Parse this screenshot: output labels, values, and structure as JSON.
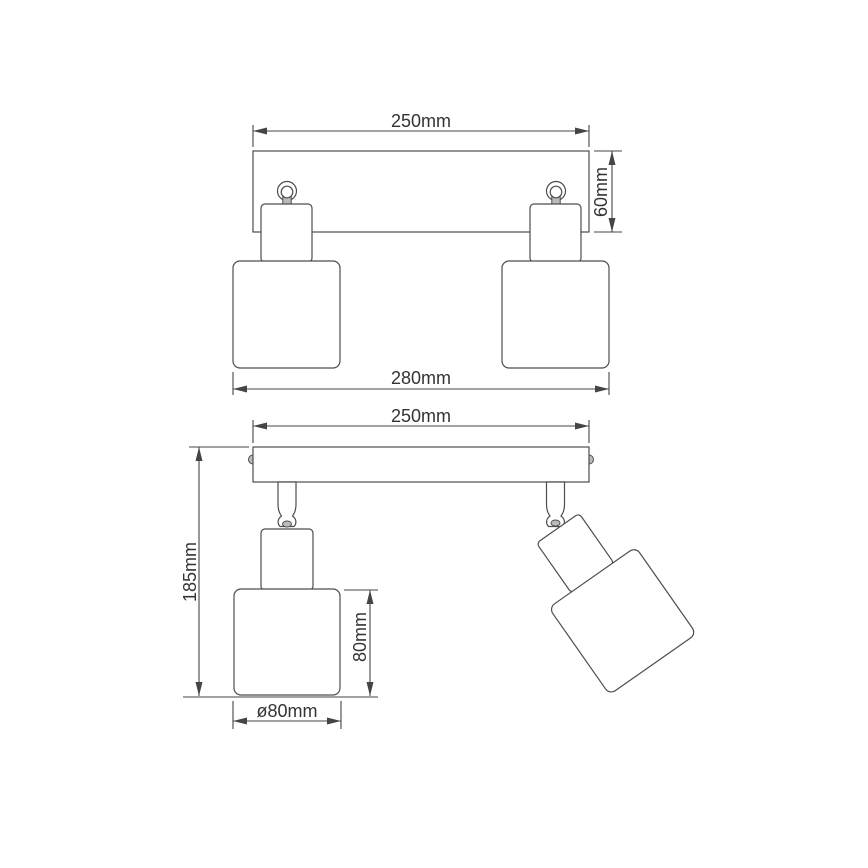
{
  "colors": {
    "line": "#4d4d4d",
    "text": "#333333",
    "surface": "#ffffff",
    "metal_fill": "#bbbbbb"
  },
  "views": {
    "front": {
      "dimensions": {
        "bar_width": {
          "text": "250mm",
          "value_mm": 250
        },
        "bar_height": {
          "text": "60mm",
          "value_mm": 60
        },
        "overall_width": {
          "text": "280mm",
          "value_mm": 280
        }
      }
    },
    "side": {
      "dimensions": {
        "bar_width": {
          "text": "250mm",
          "value_mm": 250
        },
        "overall_height": {
          "text": "185mm",
          "value_mm": 185
        },
        "shade_height": {
          "text": "80mm",
          "value_mm": 80
        },
        "shade_diameter": {
          "text": "ø80mm",
          "value_mm": 80
        }
      }
    }
  }
}
